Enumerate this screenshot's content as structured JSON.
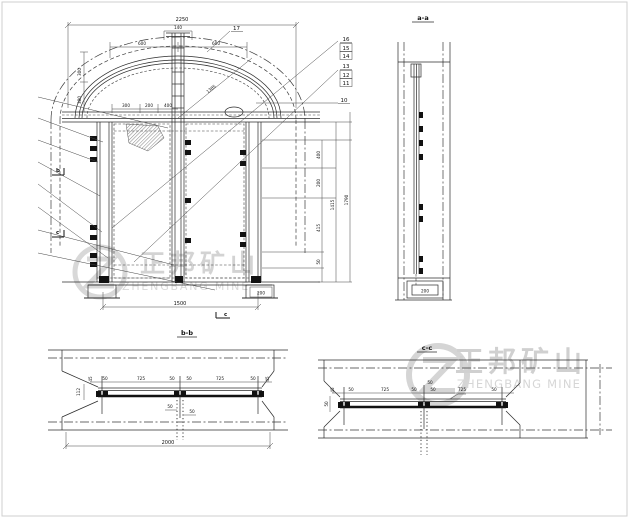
{
  "meta": {
    "bg_color": "#ffffff",
    "line_color": "#2b2b2b",
    "watermark_color": "#cccccc"
  },
  "watermark": {
    "cn": "正邦矿山",
    "en": "ZHENGBANG MINE"
  },
  "front_view": {
    "dim_overall_width": "2250",
    "dim_crown": "140",
    "dim_arch_left": "600",
    "dim_arch_right": "600",
    "dim_left_upper": "300",
    "dim_left_lower": "300",
    "dim_spring_1": "300",
    "dim_spring_2": "200",
    "dim_spring_3": "400",
    "dim_radius": "1385",
    "dim_right_1": "400",
    "dim_right_2": "200",
    "dim_right_3": "415",
    "dim_right_4": "50",
    "dim_right_inner_total": "1415",
    "dim_right_outer_total": "1790",
    "dim_opening": "1500",
    "dim_sill_offset": "200",
    "balloon_17": "17",
    "balloon_16": "16",
    "balloon_15": "15",
    "balloon_14": "14",
    "balloon_13": "13",
    "balloon_12": "12",
    "balloon_11": "11",
    "balloon_10": "10",
    "marker_b": "b",
    "marker_c_left": "c",
    "marker_c_bottom": "c"
  },
  "side_view": {
    "title": "a-a",
    "dim_footing": "200"
  },
  "section_b": {
    "title": "b-b",
    "dims_row": [
      "50",
      "725",
      "50",
      "50",
      "725",
      "50"
    ],
    "dim_end_left": "45",
    "dim_end_right": "45",
    "dim_left_vertical": "112",
    "dim_center_1": "50",
    "dim_center_2": "50",
    "dim_overall": "2000"
  },
  "section_c": {
    "title": "c-c",
    "dims_row": [
      "50",
      "725",
      "50",
      "50",
      "725",
      "50"
    ],
    "dim_end_left": "45",
    "dim_left_vertical": "50",
    "dim_center_top": "50"
  }
}
